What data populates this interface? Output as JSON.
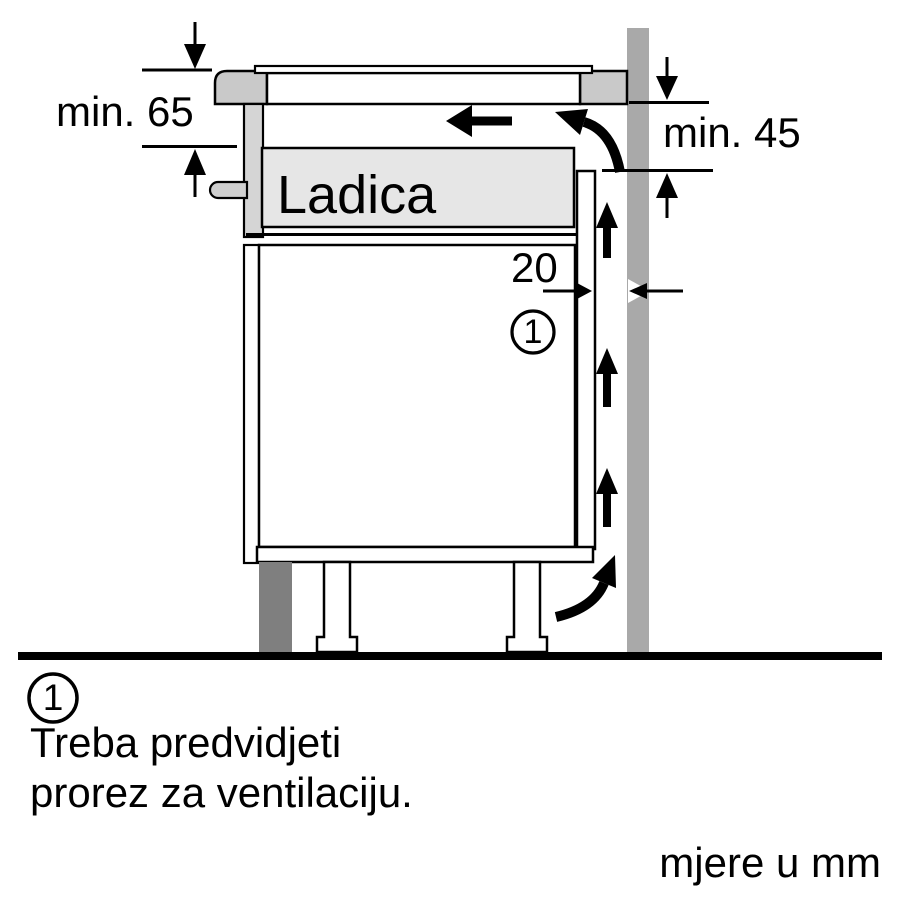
{
  "diagram": {
    "title_hint": "appliance installation side-section",
    "labels": {
      "min_worktop_to_drawer": "min. 65",
      "min_vent_opening": "min. 45",
      "vent_gap_width": "20",
      "drawer": "Ladica"
    },
    "callout": {
      "number": "1"
    },
    "colors": {
      "background": "#ffffff",
      "outline": "#000000",
      "wall": "#a9a9a9",
      "worktop": "#c9c9c9",
      "drawer_front": "#d5d5d5",
      "drawer_body": "#e6e6e6",
      "handle": "#cfcfcf",
      "plinth": "#7f7f7f"
    }
  },
  "note": {
    "number": "1",
    "line1": "Treba predvidjeti",
    "line2": "prorez za ventilaciju."
  },
  "units_caption": "mjere u mm"
}
